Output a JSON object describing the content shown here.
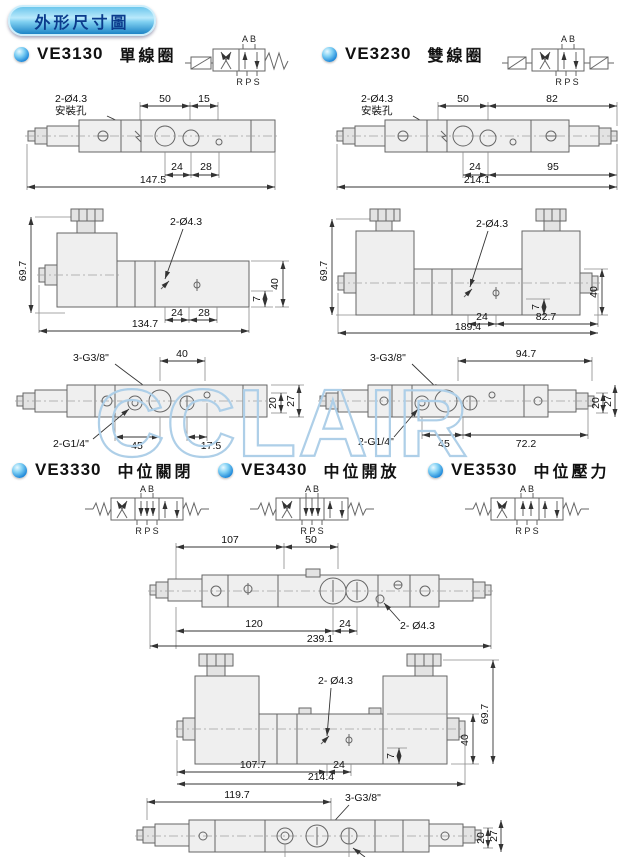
{
  "header": {
    "title": "外形尺寸圖"
  },
  "watermark": "CCLAIR",
  "symbol": {
    "ports_top": "A B",
    "ports_bottom": "R P S"
  },
  "sections": {
    "ve3130": {
      "model": "VE3130",
      "type_label": "單線圈"
    },
    "ve3230": {
      "model": "VE3230",
      "type_label": "雙線圈"
    },
    "ve3330": {
      "model": "VE3330",
      "type_label": "中位關閉"
    },
    "ve3430": {
      "model": "VE3430",
      "type_label": "中位開放"
    },
    "ve3530": {
      "model": "VE3530",
      "type_label": "中位壓力"
    }
  },
  "drawings": {
    "ve3130_top": {
      "note": "2-Ø4.3",
      "note2": "安裝孔",
      "d50": "50",
      "d15": "15",
      "d24": "24",
      "d28": "28",
      "overall": "147.5"
    },
    "ve3230_top": {
      "note": "2-Ø4.3",
      "note2": "安裝孔",
      "d50": "50",
      "d82": "82",
      "d24": "24",
      "d95": "95",
      "overall": "214.1"
    },
    "ve3130_front": {
      "h": "69.7",
      "note": "2-Ø4.3",
      "d7": "7",
      "d40": "40",
      "d24": "24",
      "d28": "28",
      "overall": "134.7"
    },
    "ve3230_front": {
      "h": "69.7",
      "note": "2-Ø4.3",
      "d7": "7",
      "d40": "40",
      "d24": "24",
      "d82_7": "82.7",
      "overall": "189.4"
    },
    "ve3130_bottom": {
      "note_g38": "3-G3/8\"",
      "d40": "40",
      "d20": "20",
      "d27": "27",
      "note_g14": "2-G1/4\"",
      "d45": "45",
      "d17_5": "17.5"
    },
    "ve3230_bottom": {
      "note_g38": "3-G3/8\"",
      "d94_7": "94.7",
      "d20": "20",
      "d27": "27",
      "note_g14": "2-G1/4\"",
      "d45": "45",
      "d72_2": "72.2"
    },
    "v3_top": {
      "d107": "107",
      "d50": "50",
      "d120": "120",
      "d24": "24",
      "note": "2- Ø4.3",
      "overall": "239.1"
    },
    "v3_front": {
      "note": "2- Ø4.3",
      "h": "69.7",
      "d40": "40",
      "d7": "7",
      "d107_7": "107.7",
      "d24": "24",
      "overall": "214.4"
    },
    "v3_bottom": {
      "d119_7": "119.7",
      "note_g38": "3-G3/8\"",
      "d20": "20",
      "d27": "27"
    }
  }
}
